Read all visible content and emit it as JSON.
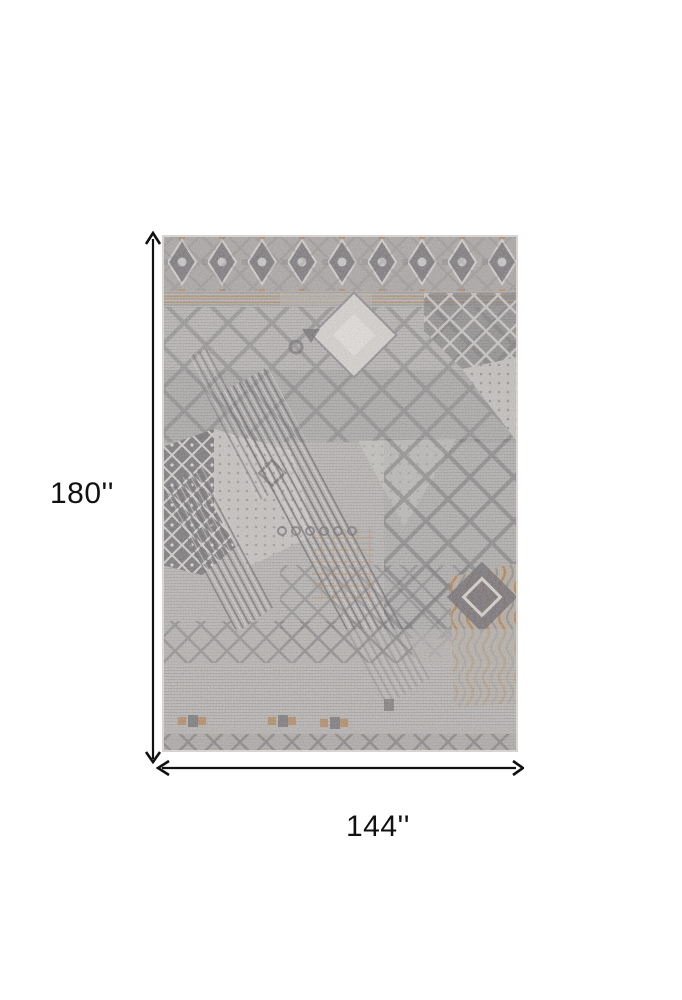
{
  "figure": {
    "type": "product-dimensions-figure",
    "alt": "Gray and ivory distressed geometric patchwork area rug shown flat, annotated with height and width dimension arrows",
    "height_label": "180''",
    "width_label": "144''"
  },
  "colors": {
    "ink": "#111111",
    "background": "#ffffff",
    "rug_base": "#b5b2af",
    "rug_dark": "#5f5b60",
    "rug_mid": "#8d898b",
    "rug_light": "#dbd8d4",
    "rug_rust": "#b07b44"
  }
}
